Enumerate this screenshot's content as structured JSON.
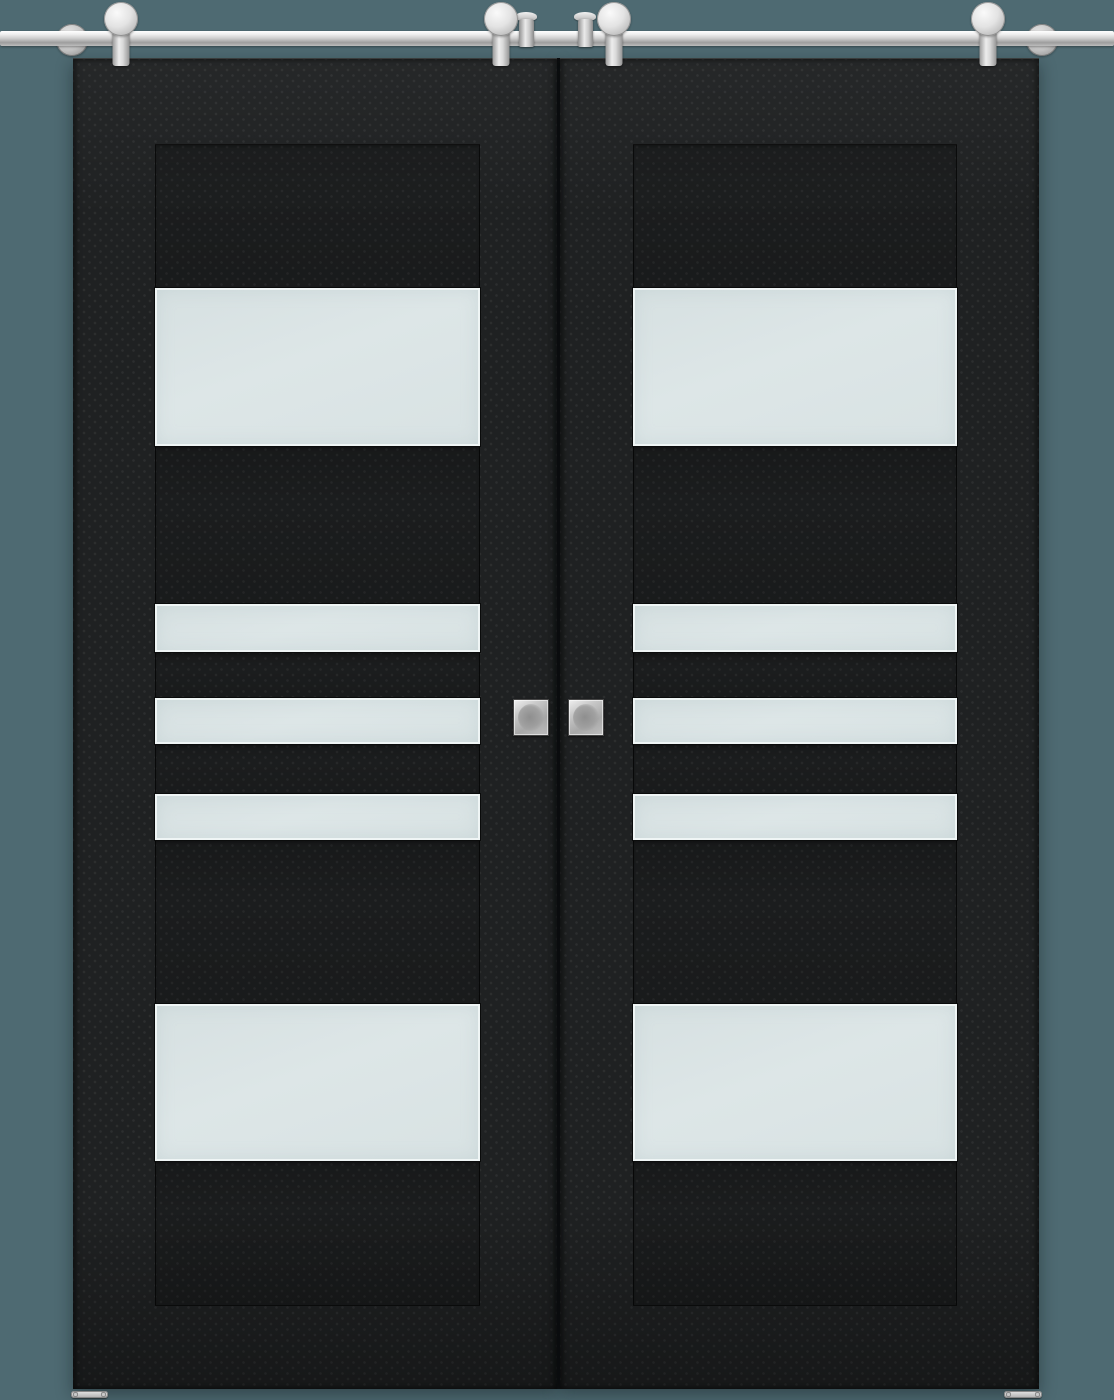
{
  "scene": {
    "type": "product-photo",
    "subject": "Double sliding barn doors in black matte finish with frosted glass panels on a stainless steel top rail"
  },
  "colors": {
    "background": "#4e6a72",
    "door_base": "#1f2122",
    "seam": "#0d0e0f",
    "frame_line": "#0c0d0d",
    "glass": "#dde6e7",
    "glass_edge": "#eff5f5",
    "handle_metal": "#a8a8a8",
    "hardware_metal": "#d6d6d6"
  },
  "door_sections": [
    {
      "type": "wood",
      "h": 144
    },
    {
      "type": "glass",
      "h": 158
    },
    {
      "type": "wood",
      "h": 158
    },
    {
      "type": "glass",
      "h": 48
    },
    {
      "type": "wood",
      "h": 46
    },
    {
      "type": "glass",
      "h": 46
    },
    {
      "type": "wood",
      "h": 50
    },
    {
      "type": "glass",
      "h": 46
    },
    {
      "type": "wood",
      "h": 164
    },
    {
      "type": "glass",
      "h": 157
    },
    {
      "type": "wood",
      "h": 145
    }
  ],
  "doors": [
    {
      "side": "left",
      "glass_panel_count": 5,
      "handle": "square flush pull"
    },
    {
      "side": "right",
      "glass_panel_count": 5,
      "handle": "square flush pull"
    }
  ],
  "hardware": {
    "rail": "stainless steel sliding rail",
    "wall_brackets": 2,
    "rollers": 4,
    "rail_stoppers": 2,
    "flush_pull_handles": 2,
    "floor_guides": 2
  }
}
